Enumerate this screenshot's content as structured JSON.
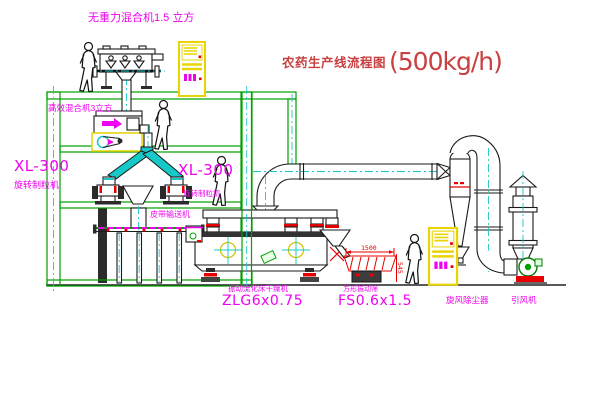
{
  "title": {
    "name": "农药生产线流程图",
    "capacity": "(500kg/h)"
  },
  "labels": {
    "gravity_mixer": "无重力混合机1.5 立方",
    "high_eff_mixer": "高效混合机3立方",
    "granulator_left_model": "XL-300",
    "granulator_left_name": "旋转制粒机",
    "granulator_center_model": "XL-300",
    "granulator_center_name": "旋转制粒机",
    "belt_conveyor": "皮带输送机",
    "fluid_bed_dryer_name": "振动流化床干燥机",
    "fluid_bed_dryer_model": "ZLG6x0.75",
    "square_vib_screen_name": "方形振动筛",
    "square_vib_screen_model": "FS0.6x1.5",
    "cyclone_dust_collector": "旋风除尘器",
    "induced_draft_fan": "引风机"
  },
  "dimensions": {
    "screen_width": "1500",
    "screen_height": "545"
  },
  "colors": {
    "line-green": "#00a000",
    "centerline-cyan": "#16c8c8",
    "label-magenta": "#f000f0",
    "detail-red": "#e80000",
    "panel-yellow": "#e8d400",
    "title-red": "#c84040",
    "machine-black": "#1a1a1a"
  }
}
